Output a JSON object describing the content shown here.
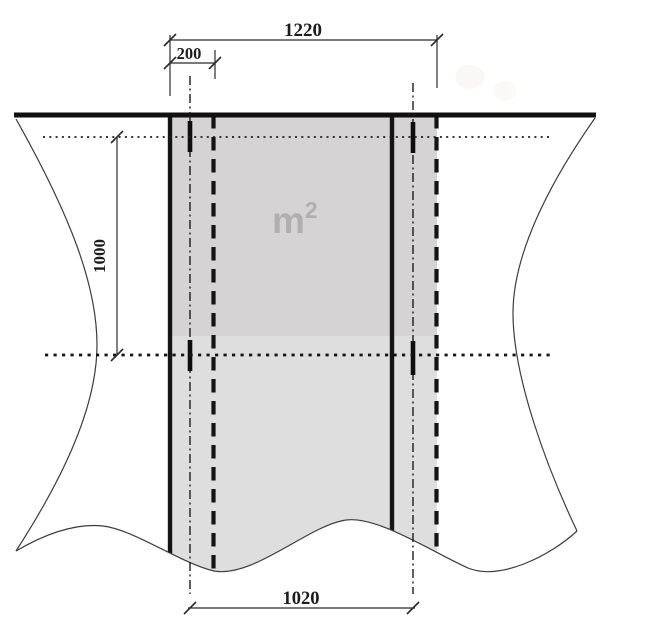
{
  "figure": {
    "kind": "technical-dimension-diagram",
    "labels": {
      "dim_total_width": "1220",
      "dim_overlap": "200",
      "dim_height": "1000",
      "dim_effective_width": "1020",
      "area_unit_base": "m",
      "area_unit_exponent": "2"
    },
    "colors": {
      "background": "#ffffff",
      "line": "#1a1a1a",
      "strip_fill_lower": "#dfdede",
      "strip_fill_upper": "#d5d3d3",
      "area_label_text": "#b0aeae"
    }
  }
}
